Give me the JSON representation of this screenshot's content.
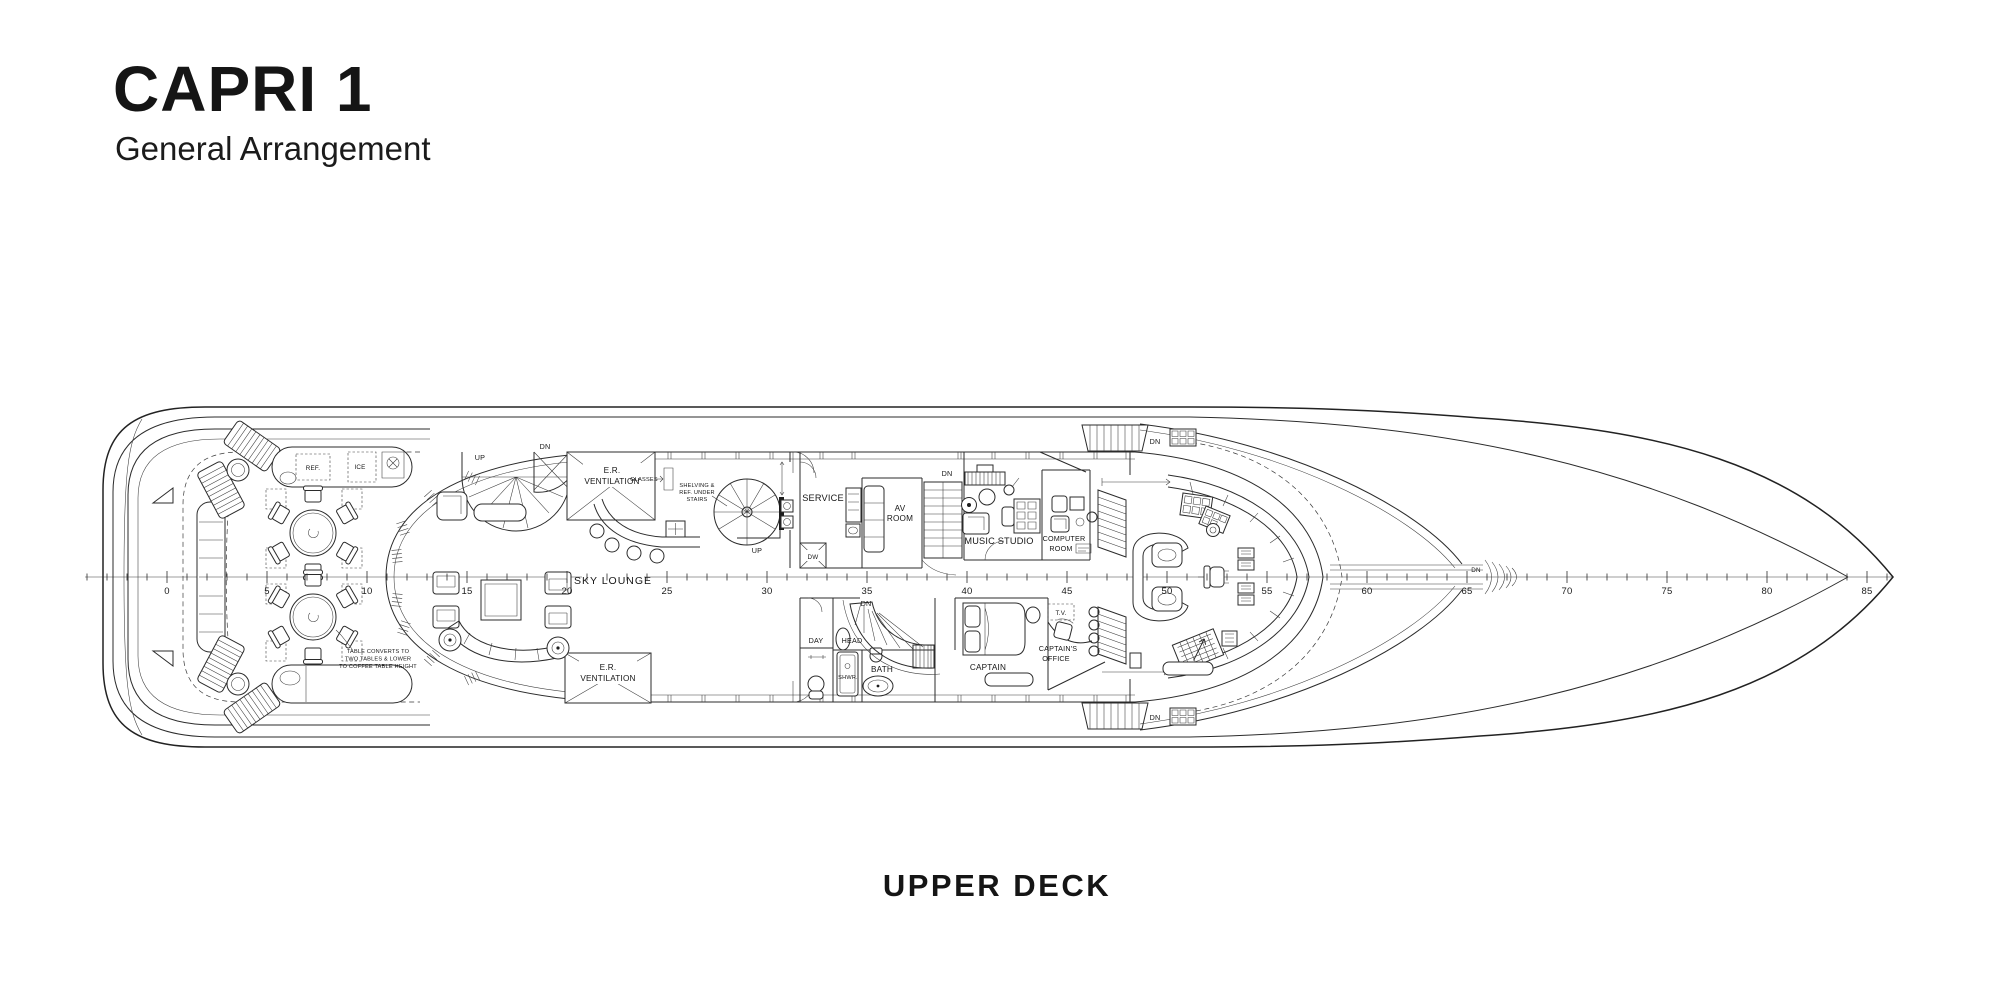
{
  "header": {
    "title": "CAPRI 1",
    "subtitle": "General Arrangement"
  },
  "footer": {
    "deck_label": "UPPER DECK"
  },
  "plan": {
    "rooms": {
      "sky_lounge": "SKY LOUNGE",
      "service": "SERVICE",
      "av_room_l1": "AV",
      "av_room_l2": "ROOM",
      "music_studio": "MUSIC STUDIO",
      "computer_room_l1": "COMPUTER",
      "computer_room_l2": "ROOM",
      "day_l1": "DAY",
      "day_l2": "HEAD",
      "bath": "BATH",
      "shower": "SHWR.",
      "captain": "CAPTAIN",
      "office_l1": "CAPTAIN'S",
      "office_l2": "OFFICE",
      "er_vent_l1": "E.R.",
      "er_vent_l2": "VENTILATION"
    },
    "equipment": {
      "dw": "DW",
      "ref": "REF.",
      "ice": "ICE",
      "tv": "T.V.",
      "glasses": "GLASSES"
    },
    "stairs": {
      "up": "UP",
      "dn": "DN"
    },
    "notes": {
      "table_note_l1": "TABLE CONVERTS TO",
      "table_note_l2": "TWO TABLES & LOWER",
      "table_note_l3": "TO COFFEE TABLE HEIGHT",
      "shelf_note_l1": "SHELVING &",
      "shelf_note_l2": "REF. UNDER",
      "shelf_note_l3": "STAIRS"
    },
    "ruler": {
      "labels": [
        "0",
        "5",
        "10",
        "15",
        "20",
        "25",
        "30",
        "35",
        "40",
        "45",
        "50",
        "55",
        "60",
        "65",
        "70",
        "75",
        "80",
        "85"
      ]
    }
  }
}
